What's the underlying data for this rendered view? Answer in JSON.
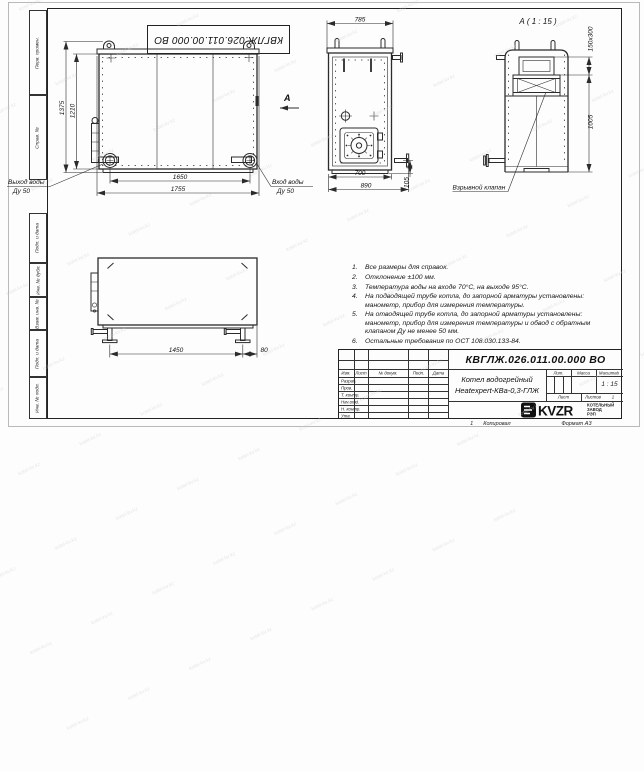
{
  "watermark_text": "kotel-kv.kz",
  "sheet": {
    "top_stamp": "КВГЛЖ.026.011.00.000 ВО",
    "side_labels": [
      "Перв. примен.",
      "Справ. №",
      "Подп. и дата",
      "Инв. № дубл.",
      "Взам. инв. №",
      "Подп. и дата",
      "Инв. № подл."
    ],
    "footer": {
      "copy_num": "1",
      "copied_by": "Копировал",
      "format": "Формат А3"
    }
  },
  "views": {
    "front": {
      "dim_height_outer": "1375",
      "dim_height_inner": "1210",
      "dim_width_inner": "1650",
      "dim_width_outer": "1755",
      "outlet_label": "Выход воды",
      "outlet_dn": "Ду 50",
      "inlet_label": "Вход воды",
      "inlet_dn": "Ду 50",
      "arrow_label": "А"
    },
    "side": {
      "dim_top": "785",
      "dim_bottom_inner": "700",
      "dim_bottom_outer": "890",
      "dim_stub": "105"
    },
    "rear": {
      "title": "А ( 1 : 15 )",
      "dim_duct": "150х300",
      "dim_height": "1005",
      "valve_label": "Взрывной клапан"
    },
    "plan": {
      "dim_length": "1450",
      "dim_offset": "80"
    }
  },
  "notes": [
    {
      "num": "1.",
      "text": "Все размеры для справок."
    },
    {
      "num": "2.",
      "text": "Отклонение ±100 мм."
    },
    {
      "num": "3.",
      "text": "Температура воды на входе 70°С, на выходе 95°С."
    },
    {
      "num": "4.",
      "text": "На подводящей трубе котла, до запорной арматуры установлены: манометр, прибор для измерения температуры."
    },
    {
      "num": "5.",
      "text": "На отводящей трубе котла, до запорной арматуры установлены: манометр, прибор для измерения температуры и обвод с обратным клапаном Ду не менее 50 мм."
    },
    {
      "num": "6.",
      "text": "Остальные требования по ОСТ 108.030.133-84."
    }
  ],
  "titleblock": {
    "doc_number": "КВГЛЖ.026.011.00.000 ВО",
    "product_line1": "Котел водогрейный",
    "product_line2": "Heatexpert-КВа-0,3-ГЛЖ",
    "col_izm": "Изм.",
    "col_list": "Лист",
    "col_doc": "№ докум.",
    "col_sign": "Подп.",
    "col_date": "Дата",
    "rows": [
      "Разраб.",
      "Пров.",
      "Т. контр.",
      "Нач.отд.",
      "Н. контр.",
      "Утв."
    ],
    "lit_label": "Лит.",
    "mass_label": "Масса",
    "scale_label": "Масштаб",
    "scale_value": "1 : 15",
    "sheet_label": "Лист",
    "sheets_label": "Листов",
    "sheets_value": "1",
    "org_logo": "KVZR",
    "org_line1": "КОТЕЛЬНЫЙ",
    "org_line2": "ЗАВОД РЭП"
  }
}
